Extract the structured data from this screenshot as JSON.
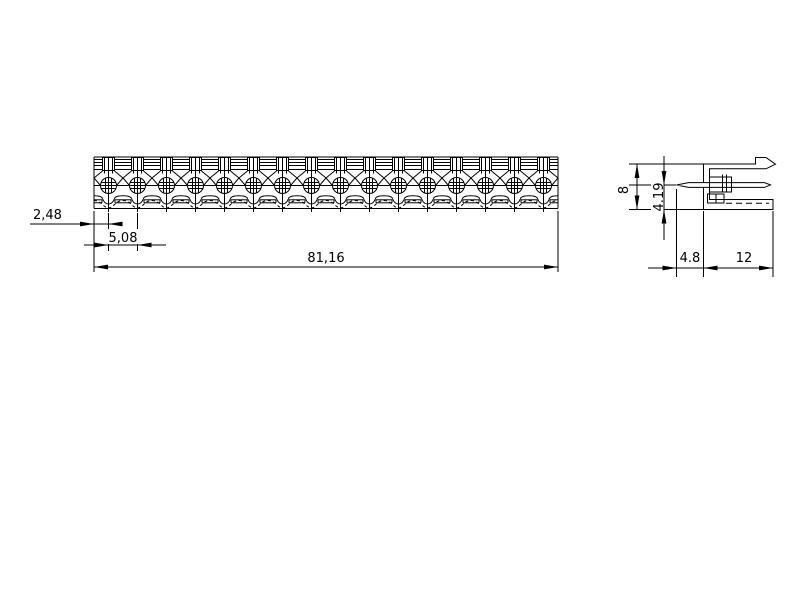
{
  "drawing": {
    "background": "#ffffff",
    "line_color": "#000000",
    "front_view": {
      "name": "front-view",
      "pin_count": 16,
      "dim_edge_to_first_pin": "2,48",
      "dim_pitch": "5,08",
      "dim_total_length": "81,16"
    },
    "side_view": {
      "name": "side-view",
      "dim_height": "8",
      "dim_pin_center_to_base": "4.19",
      "dim_pin_protrusion": "4.8",
      "dim_body_depth": "12"
    }
  }
}
